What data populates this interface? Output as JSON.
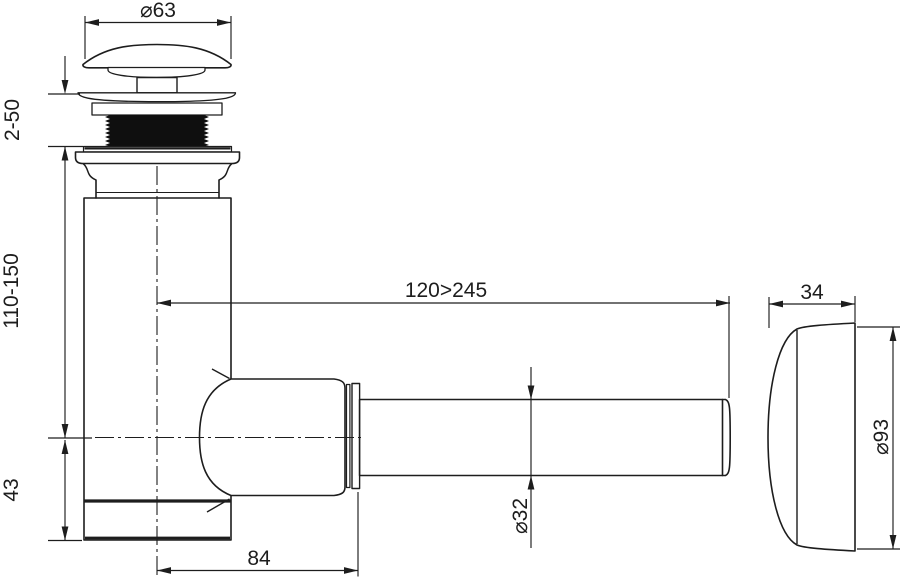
{
  "drawing": {
    "background": "#ffffff",
    "line_color": "#1d1d1d",
    "thread_fill": "#0f0f0f",
    "labels": {
      "cap_diameter": "⌀63",
      "thread_adjust_range": "2-50",
      "height_adjust_range": "110-150",
      "center_to_bottom": "43",
      "outlet_length_range": "120>245",
      "center_to_nut": "84",
      "pipe_diameter": "⌀32",
      "cap_depth": "34",
      "cap_face_diameter": "⌀93"
    }
  }
}
